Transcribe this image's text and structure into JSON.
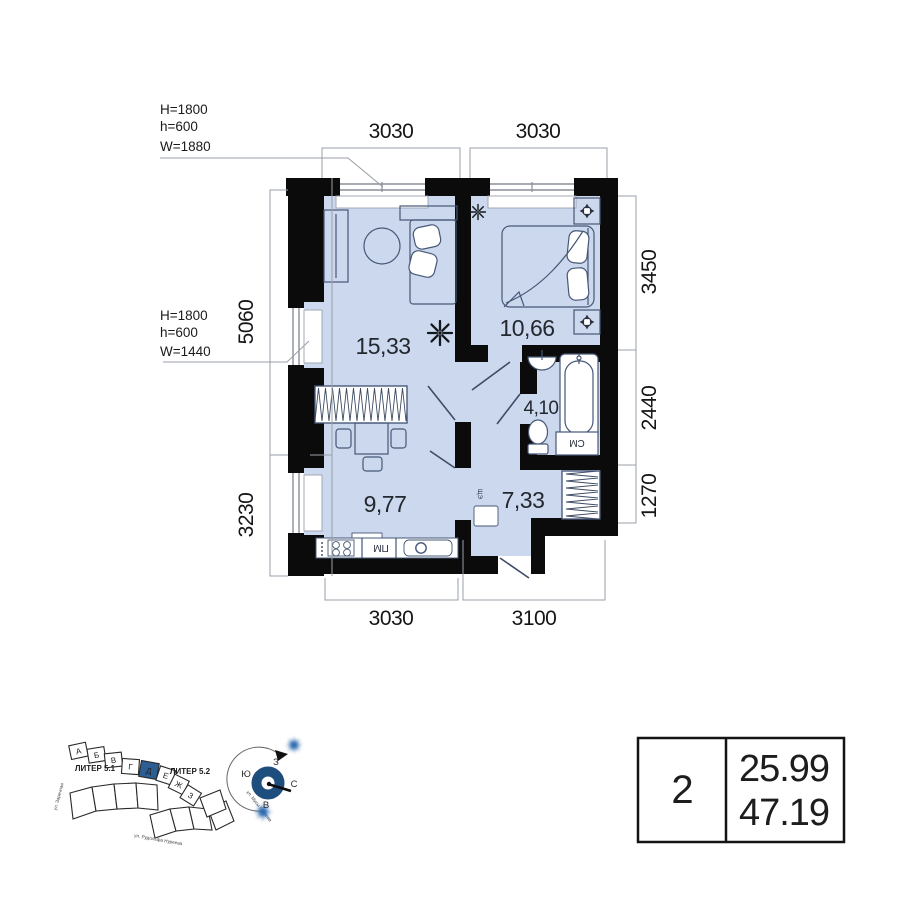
{
  "plan": {
    "annotations": {
      "win1": {
        "l1": "H=1800",
        "l2": "h=600",
        "l3": "W=1880"
      },
      "win2": {
        "l1": "H=1800",
        "l2": "h=600",
        "l3": "W=1440"
      }
    },
    "dims": {
      "top1": "3030",
      "top2": "3030",
      "right1": "3450",
      "right2": "2440",
      "right3": "1270",
      "left1": "5060",
      "left2": "3230",
      "bottom1": "3030",
      "bottom2": "3100"
    },
    "rooms": {
      "living": "15,33",
      "bedroom": "10,66",
      "bath": "4,10",
      "kitchen": "9,77",
      "hall": "7,33"
    },
    "appliances": {
      "washer": "СМ",
      "dishwasher": "ПМ",
      "panel": "ЩЭ"
    }
  },
  "site": {
    "liter1": "ЛИТЕР 5.1",
    "liter2": "ЛИТЕР 5.2",
    "blocks": {
      "a": "А",
      "b": "Б",
      "v": "В",
      "g": "Г",
      "d": "Д",
      "e": "Е",
      "zh": "Ж",
      "z": "З"
    },
    "streets": {
      "left": "ул. Заречная",
      "bottom": "ул. Рудольфа Нуреева",
      "right": "ул. Мусы Гареева"
    },
    "compass": {
      "n": "С",
      "s": "Ю",
      "w": "З",
      "e": "В"
    }
  },
  "table": {
    "rooms": "2",
    "area_living": "25.99",
    "area_total": "47.19"
  }
}
